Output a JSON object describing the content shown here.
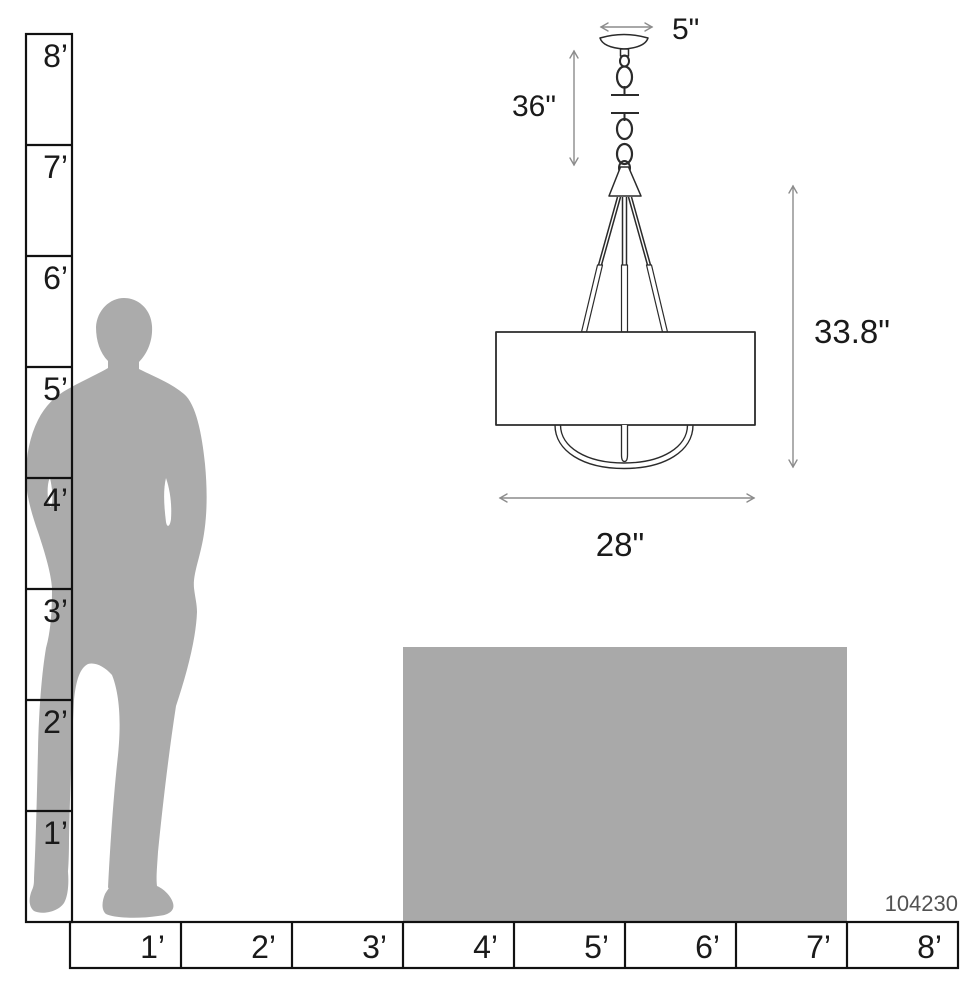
{
  "product_number": "104230",
  "dimensions": {
    "canopy_width": "5\"",
    "chain_drop": "36\"",
    "fixture_height": "33.8\"",
    "fixture_width": "28\""
  },
  "vertical_ruler": {
    "unit": "feet",
    "labels": [
      "8’",
      "7’",
      "6’",
      "5’",
      "4’",
      "3’",
      "2’",
      "1’"
    ]
  },
  "horizontal_ruler": {
    "unit": "feet",
    "labels": [
      "1’",
      "2’",
      "3’",
      "4’",
      "5’",
      "6’",
      "7’",
      "8’"
    ]
  },
  "colors": {
    "silhouette": "#ababab",
    "table": "#a9a9a9",
    "ruler_line": "#111111",
    "drawing_line": "#2b2b2b",
    "dimension_line": "#8c8c8c",
    "dimension_text": "#1a1a1a",
    "product_text": "#525252"
  }
}
